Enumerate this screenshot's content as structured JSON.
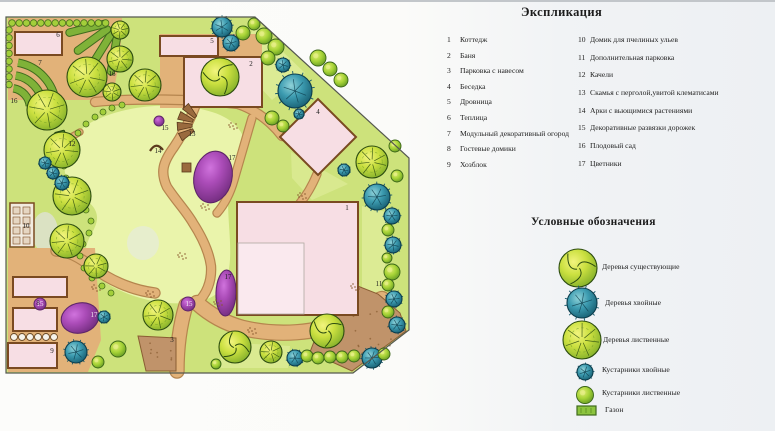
{
  "explication": {
    "title": "Экспликация",
    "col1": [
      {
        "num": "1",
        "label": "Коттедж"
      },
      {
        "num": "2",
        "label": "Баня"
      },
      {
        "num": "3",
        "label": "Парковка с навесом"
      },
      {
        "num": "4",
        "label": "Беседка"
      },
      {
        "num": "5",
        "label": "Дровница"
      },
      {
        "num": "6",
        "label": "Теплица"
      },
      {
        "num": "7",
        "label": "Модульный декоративный огород"
      },
      {
        "num": "8",
        "label": "Гостевые домики"
      },
      {
        "num": "9",
        "label": "Хозблок"
      }
    ],
    "col2": [
      {
        "num": "10",
        "label": "Домик для пчелиных ульев"
      },
      {
        "num": "11",
        "label": "Дополнительная парковка"
      },
      {
        "num": "12",
        "label": "Качели"
      },
      {
        "num": "13",
        "label": "Скамья с перголой,увитой клематисами"
      },
      {
        "num": "14",
        "label": "Арки с вьющимися растениями"
      },
      {
        "num": "15",
        "label": "Декоративные развязки дорожек"
      },
      {
        "num": "16",
        "label": "Плодовый сад"
      },
      {
        "num": "17",
        "label": "Цветники"
      }
    ]
  },
  "symbols": {
    "title": "Условные обозначения",
    "items": [
      {
        "icon": "existing-tree-icon",
        "label": "Деревья существующие"
      },
      {
        "icon": "conifer-tree-icon",
        "label": "Деревья хвойные"
      },
      {
        "icon": "deciduous-tree-icon",
        "label": "Деревья лиственные"
      },
      {
        "icon": "conifer-shrub-icon",
        "label": "Кустарники хвойные"
      },
      {
        "icon": "deciduous-shrub-icon",
        "label": "Кустарники лиственные"
      },
      {
        "icon": "lawn-icon",
        "label": "Газон"
      }
    ]
  },
  "plan": {
    "labels": [
      {
        "t": "6",
        "x": 58,
        "y": 37
      },
      {
        "t": "7",
        "x": 40,
        "y": 65
      },
      {
        "t": "16",
        "x": 112,
        "y": 76
      },
      {
        "t": "16",
        "x": 14,
        "y": 103
      },
      {
        "t": "5",
        "x": 212,
        "y": 43
      },
      {
        "t": "2",
        "x": 251,
        "y": 66
      },
      {
        "t": "4",
        "x": 318,
        "y": 114
      },
      {
        "t": "15",
        "x": 165,
        "y": 130
      },
      {
        "t": "12",
        "x": 72,
        "y": 146
      },
      {
        "t": "13",
        "x": 192,
        "y": 136
      },
      {
        "t": "14",
        "x": 158,
        "y": 153
      },
      {
        "t": "17",
        "x": 232,
        "y": 160
      },
      {
        "t": "1",
        "x": 347,
        "y": 210
      },
      {
        "t": "17",
        "x": 228,
        "y": 279
      },
      {
        "t": "15",
        "x": 189,
        "y": 306,
        "inv": true
      },
      {
        "t": "15",
        "x": 40,
        "y": 306,
        "inv": true
      },
      {
        "t": "10",
        "x": 26,
        "y": 228
      },
      {
        "t": "8",
        "x": 38,
        "y": 305
      },
      {
        "t": "9",
        "x": 52,
        "y": 353
      },
      {
        "t": "3",
        "x": 172,
        "y": 342
      },
      {
        "t": "11",
        "x": 379,
        "y": 286
      },
      {
        "t": "17",
        "x": 94,
        "y": 317,
        "inv": true
      }
    ]
  },
  "colors": {
    "lawn": "#cde27b",
    "lawn_light": "#ebf4ae",
    "path": "#e2b279",
    "path_edge": "#b5854e",
    "building_fill": "#f7dee4",
    "building_border": "#7a4a21",
    "purple": "#a848b4",
    "purple_dark": "#5e2569",
    "conifer": "#2f8da4",
    "leafy": "#c5dc3e",
    "leafy_dark": "#2c4c10",
    "parking": "#c0936a",
    "boundary": "#55584f"
  }
}
